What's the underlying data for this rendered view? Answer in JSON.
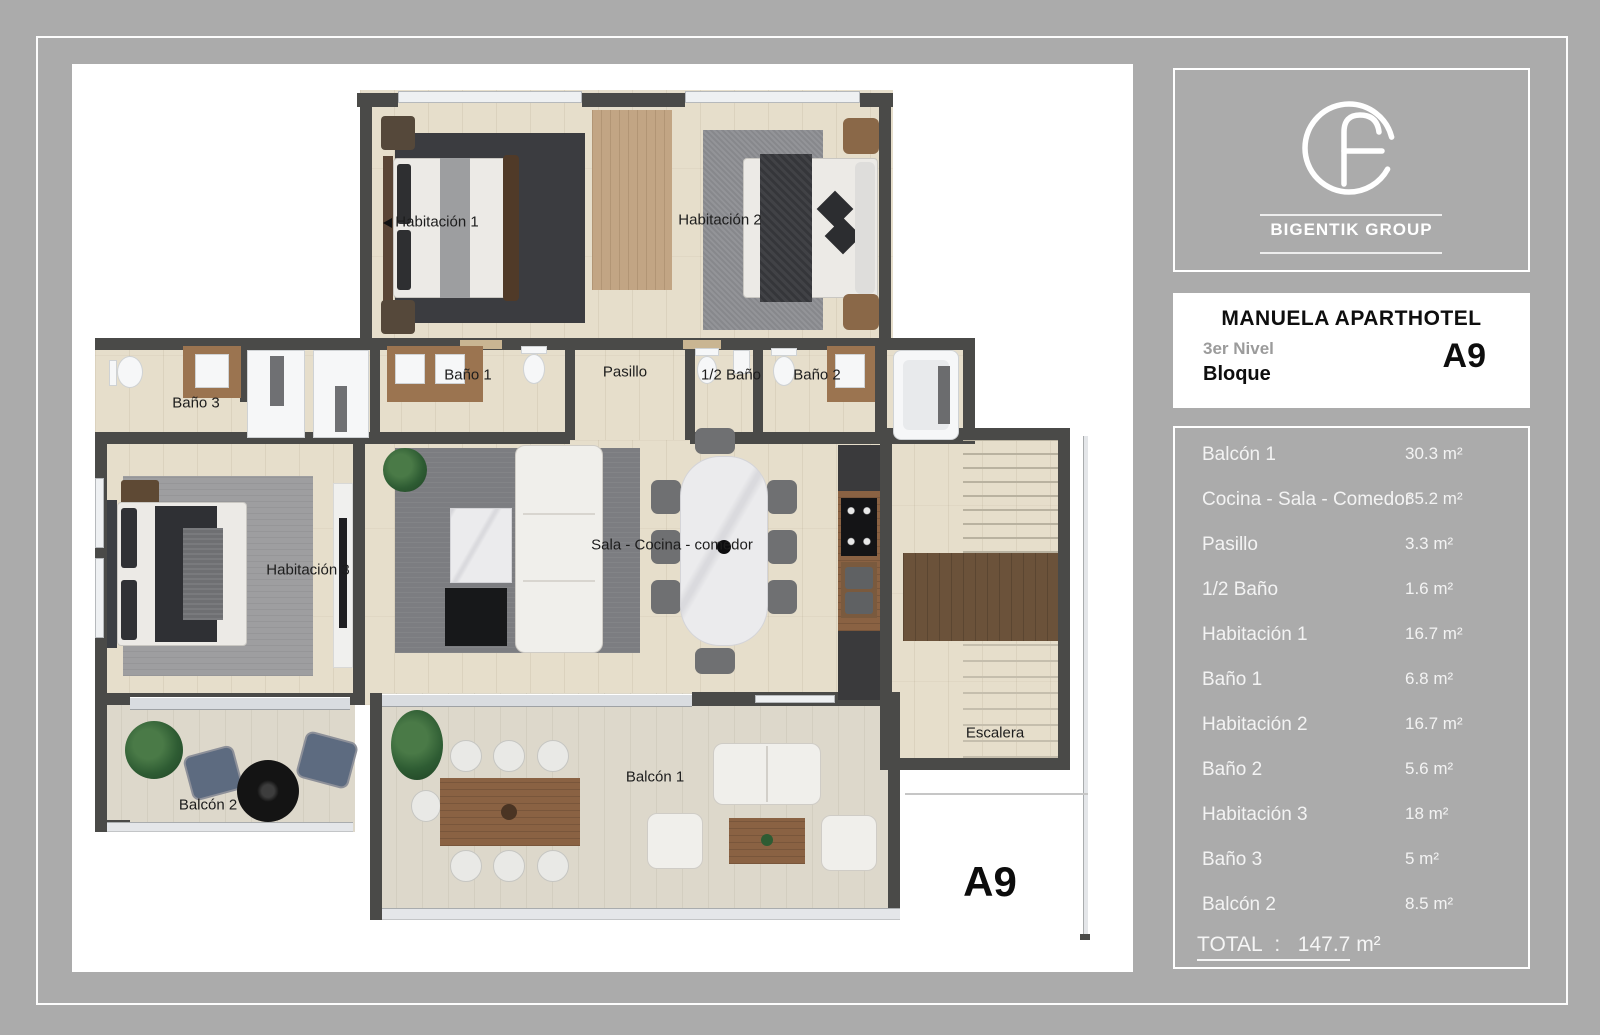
{
  "brand": {
    "name": "BIGENTIK GROUP"
  },
  "title_block": {
    "title": "MANUELA APARTHOTEL",
    "level": "3er Nivel",
    "block_word": "Bloque",
    "block_code": "A9"
  },
  "area_table": {
    "rows": [
      {
        "label": "Balcón 1",
        "area": "30.3 m²"
      },
      {
        "label": "Cocina - Sala - Comedor",
        "area": "35.2 m²"
      },
      {
        "label": "Pasillo",
        "area": "3.3 m²"
      },
      {
        "label": "1/2 Baño",
        "area": "1.6 m²"
      },
      {
        "label": "Habitación 1",
        "area": "16.7 m²"
      },
      {
        "label": "Baño 1",
        "area": "6.8 m²"
      },
      {
        "label": "Habitación 2",
        "area": "16.7 m²"
      },
      {
        "label": "Baño 2",
        "area": "5.6 m²"
      },
      {
        "label": "Habitación 3",
        "area": "18 m²"
      },
      {
        "label": "Baño 3",
        "area": "5 m²"
      },
      {
        "label": "Balcón 2",
        "area": "8.5 m²"
      }
    ],
    "total": {
      "label": "TOTAL",
      "separator": ":",
      "value": "147.7",
      "unit": "m²"
    }
  },
  "plan": {
    "unit_code": "A9",
    "labels": [
      {
        "id": "habitacion-1",
        "text": "Habitación 1"
      },
      {
        "id": "habitacion-2",
        "text": "Habitación 2"
      },
      {
        "id": "bano-1",
        "text": "Baño 1"
      },
      {
        "id": "pasillo",
        "text": "Pasillo"
      },
      {
        "id": "medio-bano",
        "text": "1/2 Baño"
      },
      {
        "id": "bano-2",
        "text": "Baño 2"
      },
      {
        "id": "bano-3",
        "text": "Baño 3"
      },
      {
        "id": "habitacion-3",
        "text": "Habitación 3"
      },
      {
        "id": "sala-cocina-comedor",
        "text": "Sala - Cocina - comedor"
      },
      {
        "id": "escalera",
        "text": "Escalera"
      },
      {
        "id": "balcon-1",
        "text": "Balcón 1"
      },
      {
        "id": "balcon-2",
        "text": "Balcón 2"
      }
    ]
  },
  "colors": {
    "canvas_gray": "#ababab",
    "wall": "#4a4a48",
    "floor_beige": "#e6decb",
    "balcony_floor": "#ddd8cb",
    "panel_border": "#ffffff",
    "table_text": "#f3f3f3",
    "label_text": "#1d1d1d",
    "wood": "#8a6243"
  }
}
